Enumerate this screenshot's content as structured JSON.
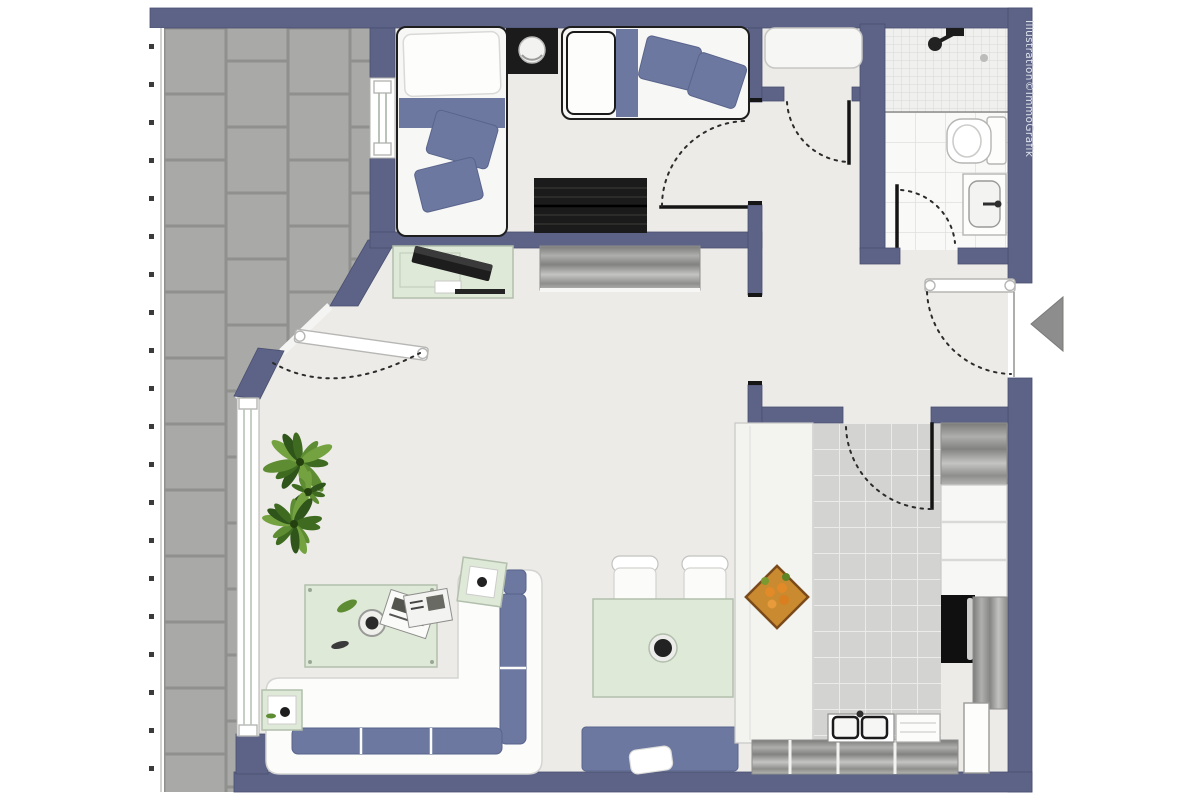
{
  "watermark": {
    "text": "Illustration©ImmoGrafik"
  },
  "entry": {
    "arrow_direction": "left"
  },
  "colors": {
    "wall": "#5c6386",
    "wall_edge": "#484f70",
    "floor": "#edebe7",
    "balcony_tile": "#a9a9a7",
    "balcony_grout": "#90908e",
    "kitchen_tile": "#d3d3d1",
    "kitchen_grout": "#ebebe9",
    "bath_floor": "#f9f9f8",
    "bath_grid": "#e0e0de",
    "shower_tile": "#f0f0ee",
    "shower_grid": "#d8d8d6",
    "accent_blue": "#6d78a0",
    "glass_green": "#dfe9d8",
    "dark_furniture": "#1b1b1b",
    "wood_mid": "#9a9a98",
    "arrow_gray": "#8d8d8d",
    "railing_post": "#3b3b3b",
    "watermark_text": "#dfe2ec",
    "plant_green": "#5d8c33",
    "fruit_orange": "#e28a28"
  },
  "inventory": {
    "rooms": [
      "balcony",
      "bedroom",
      "bathroom",
      "hallway",
      "living-dining-area",
      "kitchen"
    ],
    "fixtures": [
      "single-bed",
      "bed-with-pillows",
      "nightstand-lamp",
      "wardrobe",
      "desk-with-laptop",
      "sideboard",
      "potted-plant",
      "coffee-table",
      "corner-sofa",
      "side-table",
      "dining-table",
      "dining-chair",
      "bench-with-pillow",
      "hall-closet",
      "shower",
      "toilet",
      "washbasin",
      "kitchen-counter",
      "fruit-bowl",
      "kitchen-sink",
      "oven",
      "fridge",
      "kitchen-cabinets",
      "entrance-arrow",
      "door-swing-arc",
      "window",
      "balcony-railing"
    ]
  }
}
